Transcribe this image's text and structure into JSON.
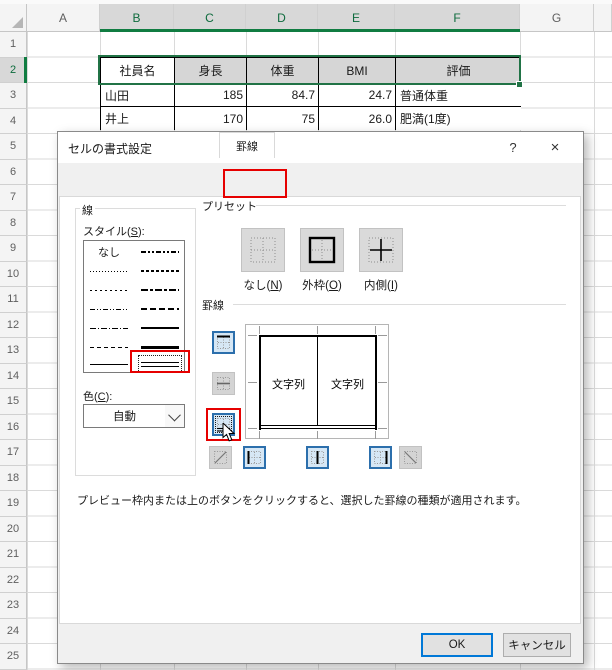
{
  "colors": {
    "excel_green": "#217346",
    "header_green": "#107c41",
    "selection_fill": "#d6d6d6",
    "annotation_red": "#e60000",
    "accent_blue": "#0078d7",
    "border_button_active_bg": "#d6e7f5",
    "border_button_active_border": "#2c6fac"
  },
  "spreadsheet": {
    "column_headers": [
      "A",
      "B",
      "C",
      "D",
      "E",
      "F",
      "G"
    ],
    "selected_columns": [
      "B",
      "C",
      "D",
      "E",
      "F"
    ],
    "row_numbers": [
      1,
      2,
      3,
      4,
      5,
      6,
      7,
      8,
      9,
      10,
      11,
      12,
      13,
      14,
      15,
      16,
      17,
      18,
      19,
      20,
      21,
      22,
      23,
      24,
      25,
      26
    ],
    "selected_row": 2,
    "table": {
      "header": [
        "社員名",
        "身長",
        "体重",
        "BMI",
        "評価"
      ],
      "rows": [
        [
          "山田",
          "185",
          "84.7",
          "24.7",
          "普通体重"
        ],
        [
          "井上",
          "170",
          "75",
          "26.0",
          "肥満(1度)"
        ]
      ]
    }
  },
  "dialog": {
    "title": "セルの書式設定",
    "help": "?",
    "close": "×",
    "tabs": [
      "表示形式",
      "配置",
      "フォント",
      "罫線",
      "塗りつぶし",
      "保護"
    ],
    "active_tab": "罫線",
    "line": {
      "group_label": "線",
      "style_label_pre": "スタイル(",
      "style_label_key": "S",
      "style_label_post": "):",
      "none_item": "なし",
      "color_label_pre": "色(",
      "color_label_key": "C",
      "color_label_post": "):",
      "color_value": "自動"
    },
    "presets": {
      "group_label": "プリセット",
      "none_pre": "なし(",
      "none_key": "N",
      "none_post": ")",
      "outline_pre": "外枠(",
      "outline_key": "O",
      "outline_post": ")",
      "inside_pre": "内側(",
      "inside_key": "I",
      "inside_post": ")"
    },
    "border": {
      "group_label": "罫線",
      "preview_cell_text": "文字列"
    },
    "description": "プレビュー枠内または上のボタンをクリックすると、選択した罫線の種類が適用されます。",
    "ok": "OK",
    "cancel": "キャンセル"
  }
}
